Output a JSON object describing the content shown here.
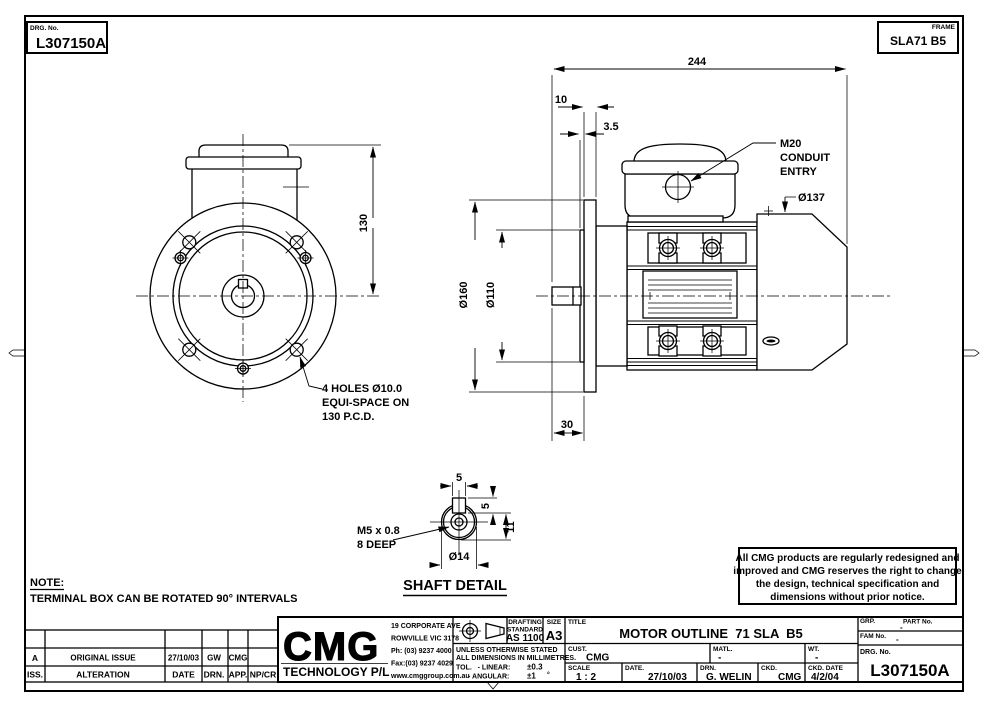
{
  "sheet": {
    "drg_no_label": "DRG. No.",
    "drg_no_value": "L307150A",
    "frame_label": "FRAME",
    "frame_value": "SLA71 B5"
  },
  "front_view": {
    "dim_height": "130",
    "holes_note": {
      "line1": "4 HOLES Ø10.0",
      "line2": "EQUI-SPACE ON",
      "line3": "130 P.C.D."
    }
  },
  "side_view": {
    "dim_overall": "244",
    "dim_flange_thickness": "10",
    "dim_spigot_step": "3.5",
    "dim_flange_dia": "Ø160",
    "dim_spigot_dia": "Ø110",
    "dim_shaft_len": "30",
    "dim_cowl_dia": "Ø137",
    "conduit": {
      "line1": "M20",
      "line2": "CONDUIT",
      "line3": "ENTRY"
    }
  },
  "shaft_detail": {
    "title": "SHAFT DETAIL",
    "dim_key_width": "5",
    "dim_key_height": "5",
    "dim_flat": "11",
    "dim_shaft_dia": "Ø14",
    "tap": {
      "line1": "M5 x 0.8",
      "line2": "8 DEEP"
    }
  },
  "note": {
    "label": "NOTE:",
    "text": "TERMINAL BOX CAN BE ROTATED 90° INTERVALS"
  },
  "disclaimer": {
    "line1": "All CMG products are regularly redesigned and",
    "line2": "improved and CMG reserves the right to change",
    "line3": "the design, technical specification and",
    "line4": "dimensions without prior notice."
  },
  "title_block": {
    "company": {
      "logo": "CMG",
      "name": "TECHNOLOGY P/L",
      "address1": "19 CORPORATE AVE",
      "address2": "ROWVILLE VIC 3178",
      "phone": "Ph: (03) 9237 4000",
      "fax": "Fax:(03) 9237 4029",
      "web": "www.cmggroup.com.au"
    },
    "drafting": {
      "line1": "DRAFTING",
      "line2": "STANDARD",
      "value": "AS 1100"
    },
    "size": {
      "label": "SIZE",
      "value": "A3"
    },
    "tolerance": {
      "line1": "UNLESS OTHERWISE STATED",
      "line2": "ALL DIMENSIONS IN MILLIMETRES.",
      "linear_label": "TOL.   - LINEAR:",
      "linear_value": "±0.3",
      "angular_label": "- ANGULAR:",
      "angular_value": "±1",
      "angular_unit": "°"
    },
    "title": {
      "label": "TITLE",
      "value": "MOTOR OUTLINE  71 SLA  B5"
    },
    "cust": {
      "label": "CUST.",
      "value": "CMG"
    },
    "matl": {
      "label": "MATL.",
      "value": "-"
    },
    "wt": {
      "label": "WT.",
      "value": "-"
    },
    "scale": {
      "label": "SCALE",
      "value": "1 : 2"
    },
    "date": {
      "label": "DATE.",
      "value": "27/10/03"
    },
    "drn": {
      "label": "DRN.",
      "value": "G. WELIN"
    },
    "ckd": {
      "label": "CKD.",
      "value": "CMG"
    },
    "ckd_date": {
      "label": "CKD. DATE",
      "value": "4/2/04"
    },
    "grp": {
      "label": "GRP.",
      "value": "-"
    },
    "part": {
      "label": "PART No."
    },
    "fam": {
      "label": "FAM No.",
      "value": "-"
    },
    "drg": {
      "label": "DRG. No.",
      "value": "L307150A"
    }
  },
  "revision_table": {
    "header": {
      "iss": "ISS.",
      "alteration": "ALTERATION",
      "date": "DATE",
      "drn": "DRN.",
      "app": "APP.",
      "npcr": "NP/CR"
    },
    "rows": [
      {
        "iss": "A",
        "alteration": "ORIGINAL ISSUE",
        "date": "27/10/03",
        "drn": "GW",
        "app": "CMG",
        "npcr": ""
      }
    ]
  }
}
